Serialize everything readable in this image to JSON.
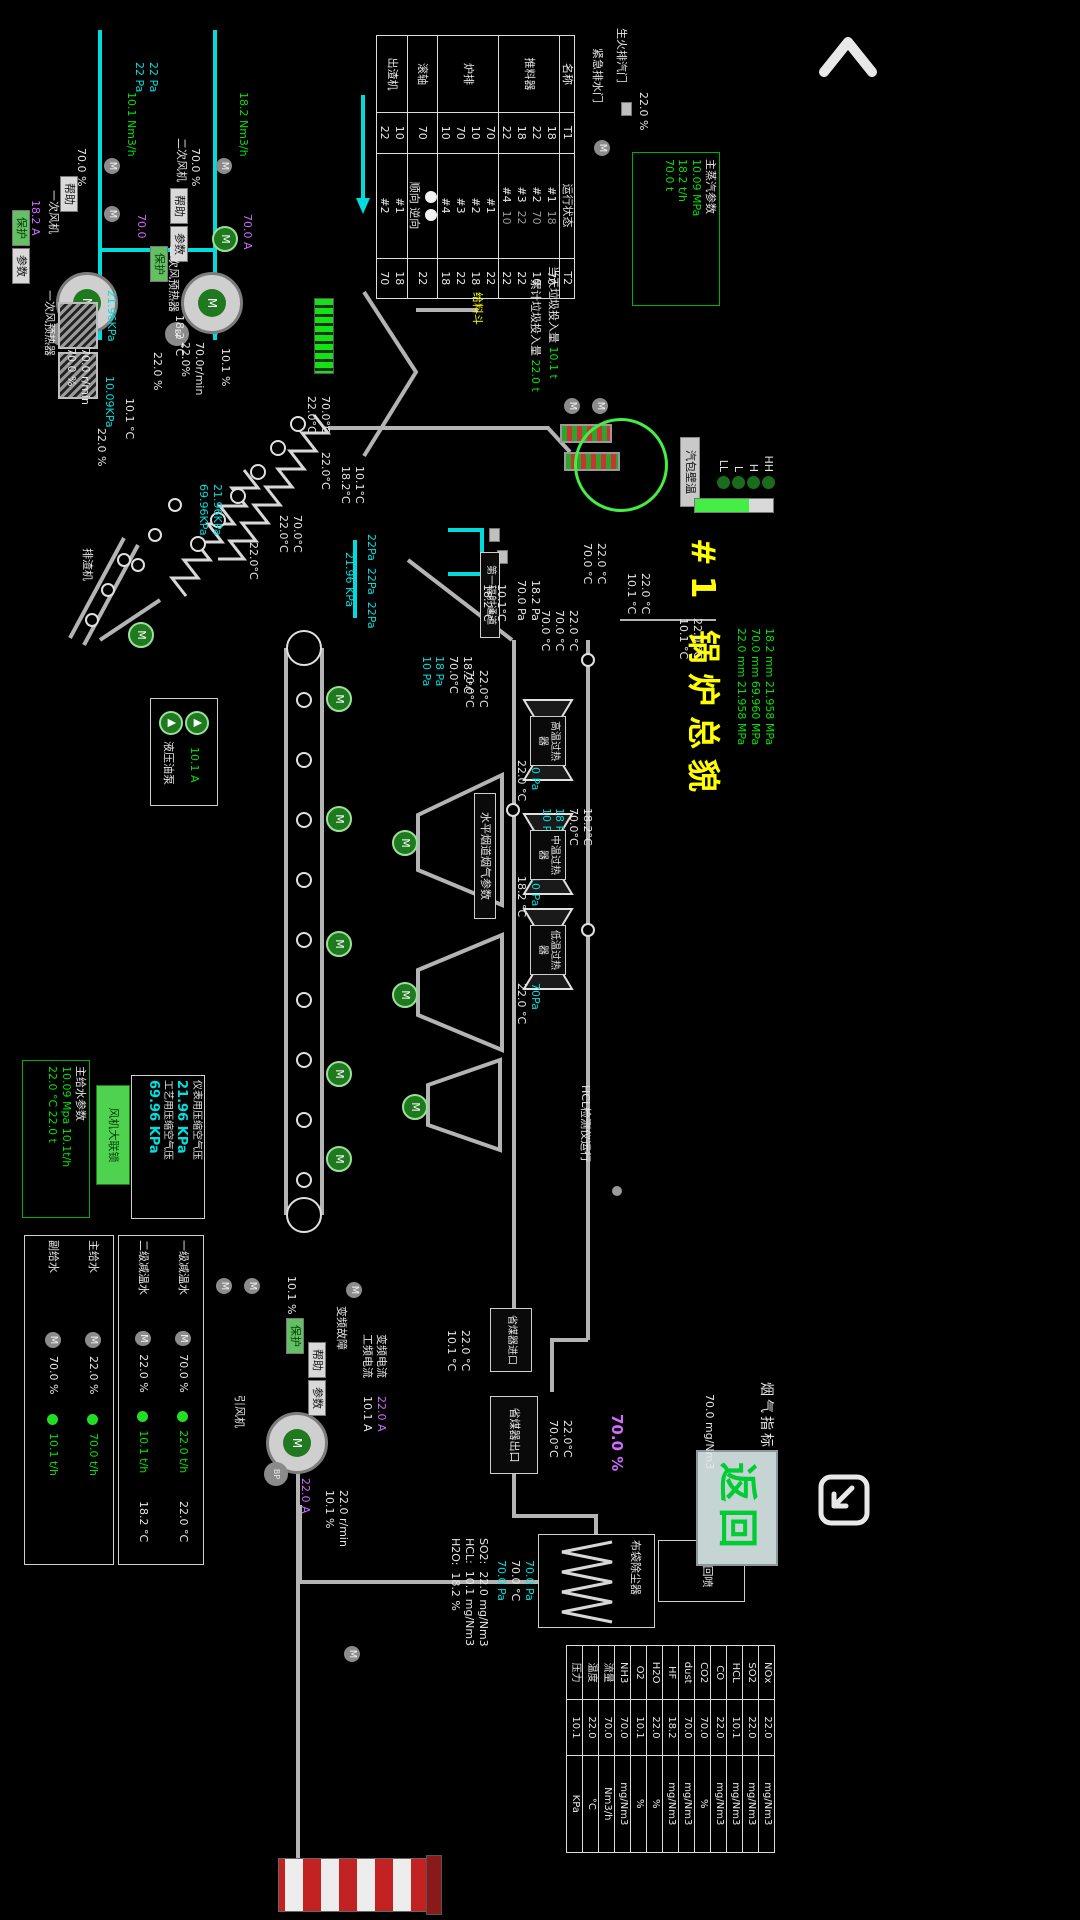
{
  "app": {
    "title": "#1 锅炉总貌",
    "back_label": "返回"
  },
  "labels": {
    "drum_wall": "汽包壁温",
    "rad1": "第一辐射通道",
    "horiz": "水平烟道烟气参数",
    "feed_hopper": "给料斗",
    "slag": "排渣机",
    "bag": "布袋除尘器",
    "ash": "灰回喷",
    "interlock": "风机大联锁",
    "btn_help": "帮助",
    "btn_param": "参数",
    "btn_prot": "保护",
    "fluegas_title": "烟气指标"
  },
  "top_valves": {
    "v1": "生火排汽门",
    "v1_pct": "22.0 %",
    "v2": "紧急排水门"
  },
  "steam_box": {
    "title": "主蒸汽参数",
    "v1": "10.09 MPa",
    "v2": "18.2 t/h",
    "v3": "70.0 t"
  },
  "waste": {
    "today_label": "当天垃圾投入量",
    "today": "10.1 t",
    "total_label": "累计垃圾投入量",
    "total": "22.0 t"
  },
  "equipment_table": {
    "headers": {
      "name": "名称",
      "t1": "T1",
      "status": "运行状态",
      "t2": "T2"
    },
    "rows": [
      {
        "name": "推料器",
        "t1": [
          "18",
          "22",
          "18",
          "22"
        ],
        "status": [
          "#1",
          "#2",
          "#3",
          "#4"
        ],
        "status_sub": [
          "18",
          "70",
          "22",
          "10"
        ],
        "t2": [
          "70",
          "10",
          "22",
          "22"
        ]
      },
      {
        "name": "炉排",
        "t1": [
          "70",
          "10",
          "70",
          "10"
        ],
        "status": [
          "#1",
          "#2",
          "#3",
          "#4"
        ],
        "status_sub": [],
        "t2": [
          "22",
          "18",
          "22",
          "18"
        ]
      },
      {
        "name": "滚轴",
        "t1": [
          "70"
        ],
        "status": [
          "顺向",
          "逆向"
        ],
        "lamps": true,
        "status_sub": [],
        "t2": [
          "22"
        ]
      },
      {
        "name": "出渣机",
        "t1": [
          "10",
          "22"
        ],
        "status": [
          "#1",
          "#2"
        ],
        "status_sub": [],
        "t2": [
          "18",
          "70"
        ]
      }
    ]
  },
  "fans": {
    "secondary": {
      "label": "二次风机"
    },
    "primary": {
      "label": "一次风机"
    }
  },
  "preheaters": {
    "secondary": "二次风预热器",
    "primary": "一次风预热器"
  },
  "drum": {
    "levels": [
      "HH",
      "H",
      "L",
      "LL"
    ]
  },
  "channels": {
    "sh": [
      "高温过热器",
      "中温过热器",
      "低温过热器"
    ]
  },
  "eco": {
    "inlet": "省煤器进口",
    "outlet": "省煤器出口",
    "hcl_label": "HCL检测仪运行"
  },
  "hyd": {
    "label": "液压油泵",
    "amp": "10.1 A"
  },
  "feedwater_box": {
    "title": "主给水参数",
    "l1": "10.09 Mpa",
    "l2": "10.1t/h",
    "l3": "22.0 °C",
    "l4": "22.0 t"
  },
  "air_box": {
    "r1_label": "仪表用压缩空气压",
    "r1_val": "21.96 KPa",
    "r2_label": "工艺用压缩空气压",
    "r2_val": "69.96 KPa"
  },
  "desuper_panel": {
    "rows": [
      {
        "label": "一级减温水",
        "pct": "70.0 %",
        "flow": "22.0 t/h",
        "temp": "22.0 °C"
      },
      {
        "label": "二级减温水",
        "pct": "22.0 %",
        "flow": "10.1 t/h",
        "temp": "18.2 °C"
      }
    ]
  },
  "feed_panel": {
    "rows": [
      {
        "label": "主给水",
        "pct": "22.0 %",
        "flow": "70.0 t/h"
      },
      {
        "label": "副给水",
        "pct": "70.0 %",
        "flow": "10.1 t/h"
      }
    ]
  },
  "idfan": {
    "label": "引风机"
  },
  "flue_table": {
    "rows": [
      {
        "name": "NOx",
        "value": "22.0",
        "unit": "mg/Nm3"
      },
      {
        "name": "SO2",
        "value": "22.0",
        "unit": "mg/Nm3"
      },
      {
        "name": "HCL",
        "value": "10.1",
        "unit": "mg/Nm3"
      },
      {
        "name": "CO",
        "value": "22.0",
        "unit": "mg/Nm3"
      },
      {
        "name": "CO2",
        "value": "70.0",
        "unit": "%"
      },
      {
        "name": "dust",
        "value": "70.0",
        "unit": "mg/Nm3"
      },
      {
        "name": "HF",
        "value": "18.2",
        "unit": "mg/Nm3"
      },
      {
        "name": "H2O",
        "value": "22.0",
        "unit": "%"
      },
      {
        "name": "O2",
        "value": "10.1",
        "unit": "%"
      },
      {
        "name": "NH3",
        "value": "70.0",
        "unit": "mg/Nm3"
      },
      {
        "name": "流量",
        "value": "70.0",
        "unit": "Nm3/h"
      },
      {
        "name": "温度",
        "value": "22.0",
        "unit": "°C"
      },
      {
        "name": "压力",
        "value": "10.1",
        "unit": "KPa"
      }
    ]
  },
  "annotations": [
    {
      "n": "fan2-flow",
      "x": 92,
      "y": 550,
      "l": [
        [
          "18.2 Nm3/h",
          "g"
        ]
      ]
    },
    {
      "n": "fan2-pct",
      "x": 148,
      "y": 598,
      "l": [
        [
          "70.0 %",
          "w"
        ]
      ]
    },
    {
      "n": "fan2-amp",
      "x": 214,
      "y": 546,
      "l": [
        [
          "70.0 A",
          "m"
        ]
      ]
    },
    {
      "n": "fan2-speed",
      "x": 342,
      "y": 594,
      "l": [
        [
          "70.0r/min",
          "w"
        ],
        [
          "22.0%",
          "w"
        ]
      ]
    },
    {
      "n": "fan1-flow",
      "x": 92,
      "y": 662,
      "l": [
        [
          "10.1 Nm3/h",
          "g"
        ]
      ]
    },
    {
      "n": "fan1-pct",
      "x": 148,
      "y": 712,
      "l": [
        [
          "70.0 %",
          "w"
        ]
      ]
    },
    {
      "n": "fan1-amp2",
      "x": 214,
      "y": 652,
      "l": [
        [
          "70.0",
          "m"
        ]
      ]
    },
    {
      "n": "fan1-speed",
      "x": 348,
      "y": 708,
      "l": [
        [
          "70.0 r/min",
          "w"
        ],
        [
          "70.0 %",
          "w"
        ]
      ]
    },
    {
      "n": "fan1-pa",
      "x": 62,
      "y": 640,
      "l": [
        [
          "22 Pa",
          "c"
        ],
        [
          "22 Pa",
          "c"
        ]
      ]
    },
    {
      "n": "fan1-amp",
      "x": 200,
      "y": 758,
      "l": [
        [
          "18.2 A",
          "m"
        ]
      ]
    },
    {
      "n": "ph2-kpa",
      "x": 290,
      "y": 682,
      "l": [
        [
          "21.96KPa",
          "c"
        ]
      ]
    },
    {
      "n": "ph2-temp",
      "x": 315,
      "y": 614,
      "l": [
        [
          "18.2 °C",
          "w"
        ]
      ]
    },
    {
      "n": "ph2-pct1",
      "x": 348,
      "y": 568,
      "l": [
        [
          "10.1 %",
          "w"
        ]
      ]
    },
    {
      "n": "ph2-pct2",
      "x": 352,
      "y": 636,
      "l": [
        [
          "22.0 %",
          "w"
        ]
      ]
    },
    {
      "n": "ph1-kpa",
      "x": 376,
      "y": 684,
      "l": [
        [
          "10.09KPa",
          "c"
        ]
      ]
    },
    {
      "n": "ph1-temp",
      "x": 398,
      "y": 664,
      "l": [
        [
          "10.1 °C",
          "w"
        ]
      ]
    },
    {
      "n": "ph1-pct",
      "x": 428,
      "y": 692,
      "l": [
        [
          "22.0 %",
          "w"
        ]
      ]
    },
    {
      "n": "grate-kpa",
      "x": 484,
      "y": 576,
      "l": [
        [
          "21.96KPa",
          "c"
        ],
        [
          "69.96KPa",
          "c"
        ]
      ]
    },
    {
      "n": "grate-t1",
      "x": 396,
      "y": 468,
      "l": [
        [
          "70.0°C",
          "w"
        ],
        [
          "22.0°C",
          "w"
        ]
      ]
    },
    {
      "n": "grate-t2",
      "x": 452,
      "y": 468,
      "l": [
        [
          "22.0°C",
          "w"
        ]
      ]
    },
    {
      "n": "grate-t3",
      "x": 466,
      "y": 434,
      "l": [
        [
          "10.1°C",
          "w"
        ],
        [
          "18.2°C",
          "w"
        ]
      ]
    },
    {
      "n": "grate-t4",
      "x": 515,
      "y": 496,
      "l": [
        [
          "70.0°C",
          "w"
        ],
        [
          "22.0°C",
          "w"
        ]
      ]
    },
    {
      "n": "grate-t5",
      "x": 542,
      "y": 540,
      "l": [
        [
          "22.0°C",
          "w"
        ]
      ]
    },
    {
      "n": "drum-mm",
      "x": 628,
      "y": 24,
      "l": [
        [
          "18.2 mm 21.958 MPa",
          "g"
        ],
        [
          "70.0 mm 69.960 MPa",
          "g"
        ],
        [
          "22.0 mm 21.958 MPa",
          "g"
        ]
      ]
    },
    {
      "n": "pass1-t1",
      "x": 573,
      "y": 148,
      "l": [
        [
          "22.0 °C",
          "w"
        ],
        [
          "10.1 °C",
          "w"
        ]
      ]
    },
    {
      "n": "pass1-t2",
      "x": 618,
      "y": 96,
      "l": [
        [
          "22.0 °C",
          "w"
        ],
        [
          "10.1 °C",
          "w"
        ]
      ]
    },
    {
      "n": "pass1-t3",
      "x": 543,
      "y": 192,
      "l": [
        [
          "22.0 °C",
          "w"
        ],
        [
          "70.0 °C",
          "w"
        ]
      ]
    },
    {
      "n": "pass1-t4",
      "x": 610,
      "y": 220,
      "l": [
        [
          "22.0 °C",
          "w"
        ],
        [
          "70.0 °C",
          "w"
        ],
        [
          "70.0 °C",
          "w"
        ]
      ]
    },
    {
      "n": "pass1-t5",
      "x": 670,
      "y": 310,
      "l": [
        [
          "22.0°C",
          "w"
        ],
        [
          "70.0°C",
          "w"
        ]
      ]
    },
    {
      "n": "pass1-t6",
      "x": 584,
      "y": 292,
      "l": [
        [
          "10.1°C",
          "w"
        ],
        [
          "18.2°C",
          "w"
        ]
      ]
    },
    {
      "n": "duct-pa1",
      "x": 580,
      "y": 258,
      "l": [
        [
          "18.2 Pa",
          "w"
        ],
        [
          "70.0 Pa",
          "w"
        ]
      ]
    },
    {
      "n": "duct-c1",
      "x": 656,
      "y": 326,
      "l": [
        [
          "18.2°C",
          "w"
        ],
        [
          "70.0°C",
          "w"
        ],
        [
          "18 Pa",
          "c"
        ],
        [
          "10 Pa",
          "c"
        ]
      ]
    },
    {
      "n": "duct-c2",
      "x": 808,
      "y": 206,
      "l": [
        [
          "18.2°C",
          "w"
        ],
        [
          "70.0°C",
          "w"
        ],
        [
          "18 Pa",
          "c"
        ],
        [
          "10 Pa",
          "c"
        ]
      ]
    },
    {
      "n": "channel-r1",
      "x": 760,
      "y": 258,
      "l": [
        [
          "70 Pa",
          "c"
        ],
        [
          "22.0 °C",
          "w"
        ]
      ]
    },
    {
      "n": "channel-r2",
      "x": 876,
      "y": 258,
      "l": [
        [
          "10 Pa",
          "c"
        ],
        [
          "18.2 °C",
          "w"
        ]
      ]
    },
    {
      "n": "channel-r3",
      "x": 983,
      "y": 258,
      "l": [
        [
          "70Pa",
          "c"
        ],
        [
          "22.0 °C",
          "w"
        ]
      ]
    },
    {
      "n": "eco-in-temps",
      "x": 1330,
      "y": 328,
      "l": [
        [
          "22.0 °C",
          "w"
        ],
        [
          "10.1 °C",
          "w"
        ]
      ]
    },
    {
      "n": "eco-out-temps",
      "x": 1420,
      "y": 226,
      "l": [
        [
          "22.0°C",
          "w"
        ],
        [
          "70.0°C",
          "w"
        ]
      ]
    },
    {
      "n": "eco-o2-pct",
      "x": 1414,
      "y": 174,
      "s": 15,
      "l": [
        [
          "70.0 %",
          "m"
        ]
      ]
    },
    {
      "n": "hcl-value",
      "x": 1394,
      "y": 84,
      "l": [
        [
          "70.0 mg/Nm3",
          "w"
        ]
      ]
    },
    {
      "n": "bag-readings",
      "x": 1560,
      "y": 264,
      "l": [
        [
          "70.0 Pa",
          "c"
        ],
        [
          "70.0 °C",
          "w"
        ],
        [
          "70.0 Pa",
          "c"
        ]
      ]
    },
    {
      "n": "stack-gas",
      "x": 1538,
      "y": 310,
      "l": [
        [
          "SO2:  22.0 mg/Nm3",
          "w"
        ],
        [
          "HCL:  10.1 mg/Nm3",
          "w"
        ],
        [
          "H2O:  18.2 %",
          "w"
        ]
      ]
    },
    {
      "n": "idfan-speed",
      "x": 1490,
      "y": 450,
      "l": [
        [
          "22.0 r/min",
          "w"
        ],
        [
          "10.1 %",
          "w"
        ]
      ]
    },
    {
      "n": "idfan-amp",
      "x": 1478,
      "y": 488,
      "l": [
        [
          "22.0 A",
          "m"
        ]
      ]
    },
    {
      "n": "idfan-fault",
      "x": 1306,
      "y": 452,
      "l": [
        [
          "变频故障",
          "w"
        ]
      ]
    },
    {
      "n": "idfan-cur-labels",
      "x": 1334,
      "y": 412,
      "l": [
        [
          "变频电流",
          "w"
        ],
        [
          "工频电流",
          "w"
        ]
      ]
    },
    {
      "n": "idfan-currents",
      "x": 1396,
      "y": 412,
      "l": [
        [
          "22.0 A",
          "m"
        ],
        [
          "10.1 A",
          "w"
        ]
      ]
    },
    {
      "n": "idfan-pct",
      "x": 1276,
      "y": 502,
      "l": [
        [
          "10.1 %",
          "w"
        ]
      ]
    },
    {
      "n": "startup-valve-pct",
      "x": 92,
      "y": 150,
      "l": [
        [
          "22.0 %",
          "w"
        ]
      ]
    },
    {
      "n": "steam-pa",
      "x": 534,
      "y": 422,
      "l": [
        [
          "22Pa  22Pa  22Pa",
          "c"
        ]
      ]
    },
    {
      "n": "steam-kpa",
      "x": 552,
      "y": 444,
      "l": [
        [
          "21.96 KPa",
          "c"
        ]
      ]
    }
  ]
}
